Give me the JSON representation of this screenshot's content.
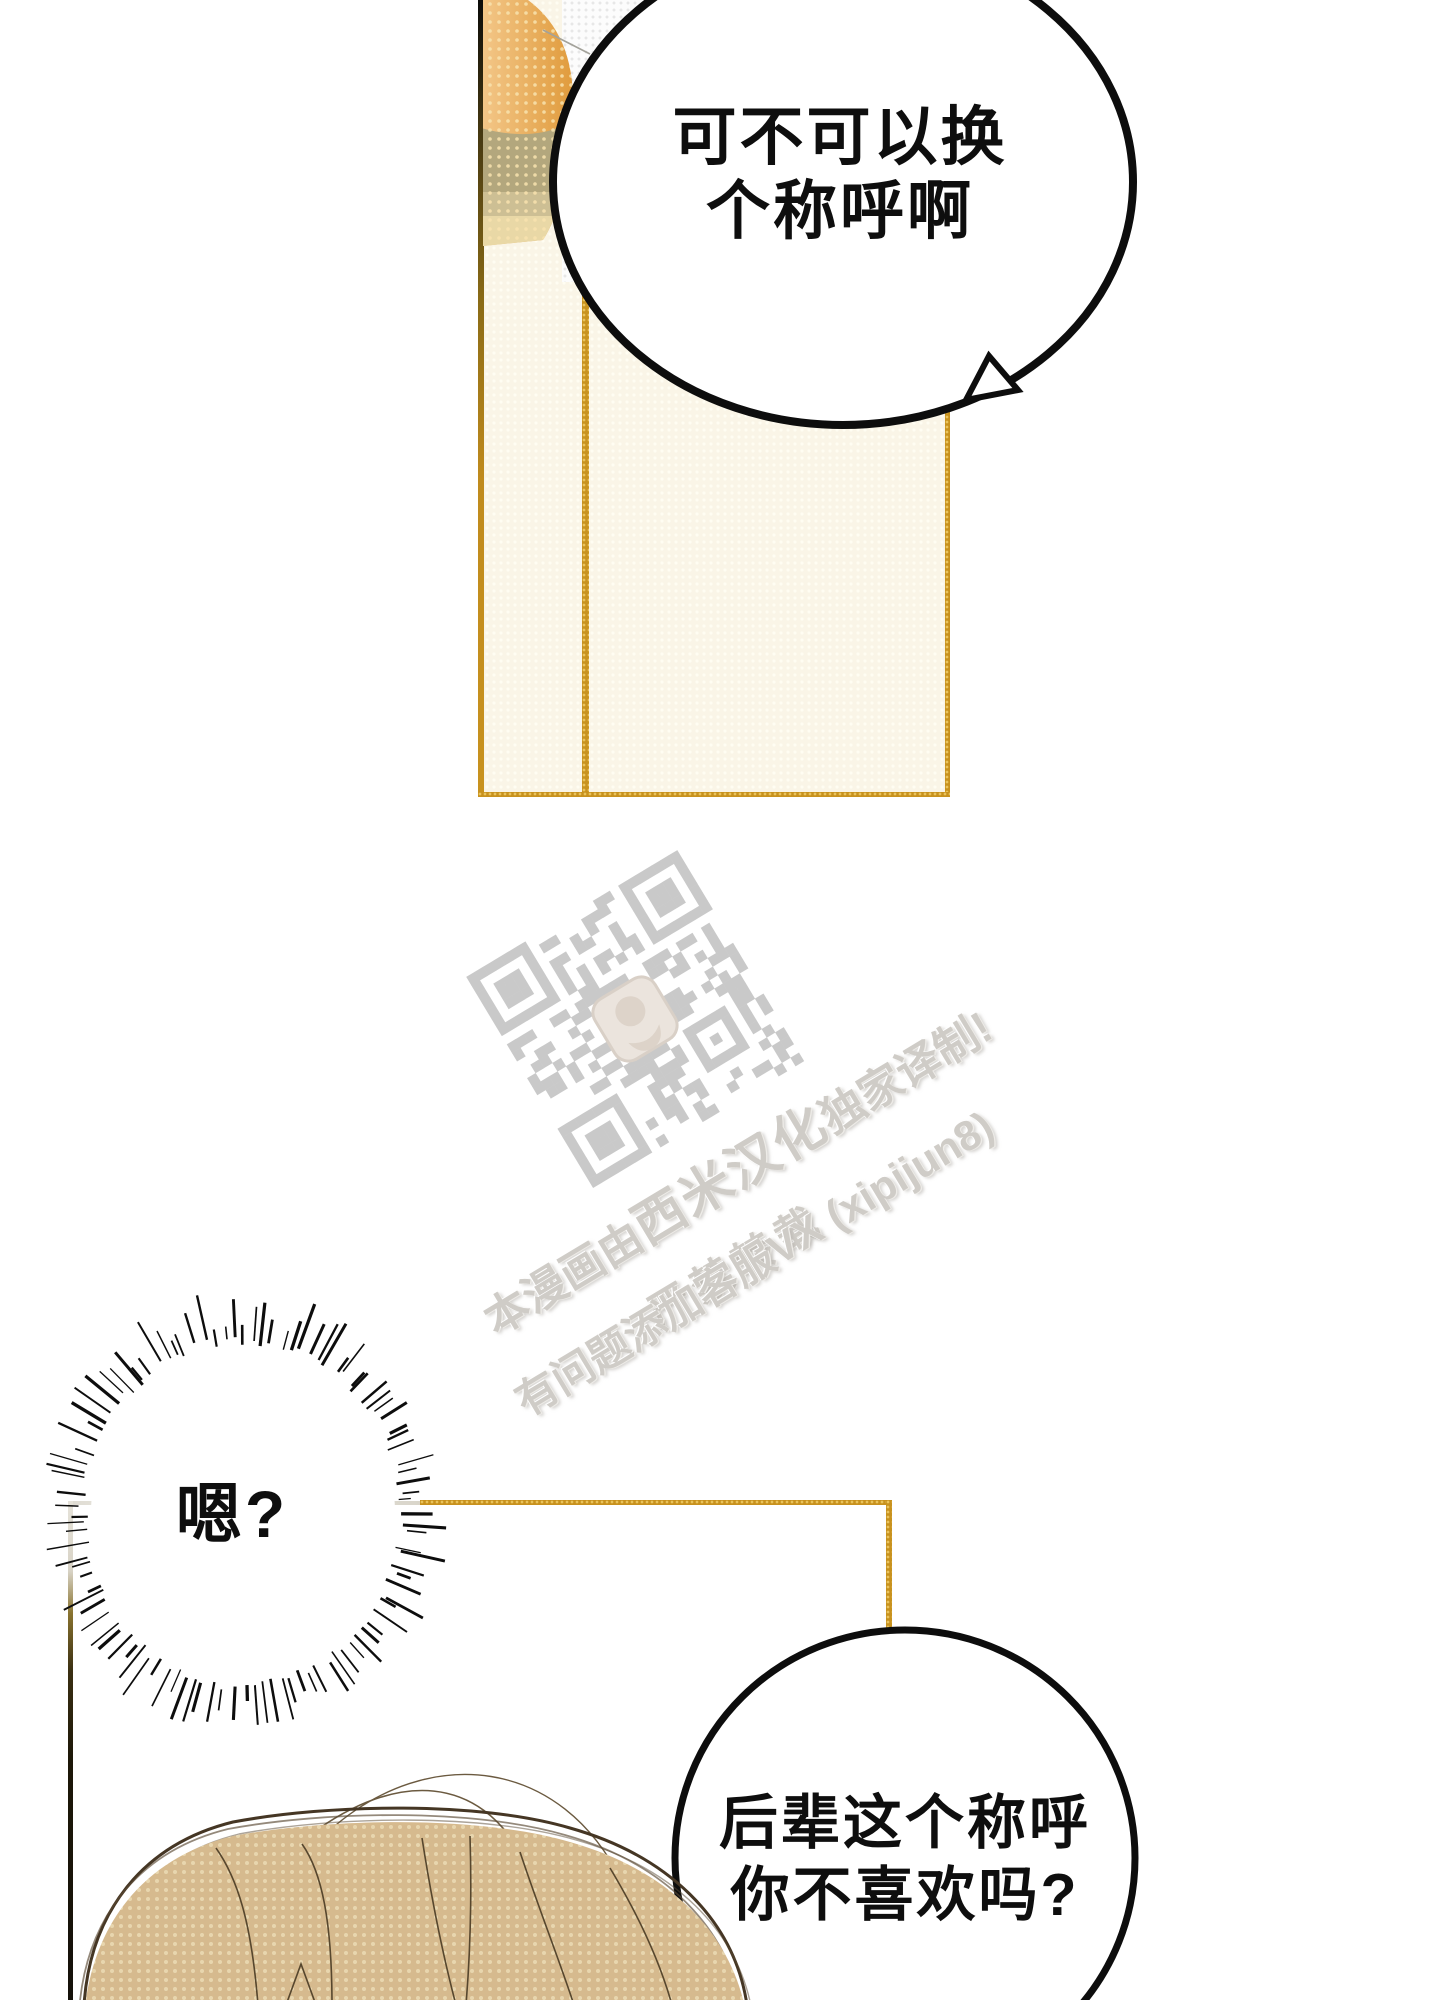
{
  "comic": {
    "bubble_top": {
      "line1": "可不可以换",
      "line2": "个称呼啊"
    },
    "bubble_burst": {
      "text": "嗯?"
    },
    "bubble_bottom": {
      "line1": "后辈这个称呼",
      "line2": "你不喜欢吗?"
    }
  },
  "watermark": {
    "line1_prefix": "本漫画由",
    "line1_brand": "西米汉化",
    "line1_suffix": "独家译制!",
    "line2": "严禁转载",
    "line3": "有问题添加客服VX (xipijun8)"
  },
  "colors": {
    "panel_gold": "#c8921e",
    "panel_cream": "#faf5e7",
    "watermark_gray": "#c9c9c9",
    "hair_tan": "#d6ba8e",
    "ink": "#0e0e0e"
  }
}
